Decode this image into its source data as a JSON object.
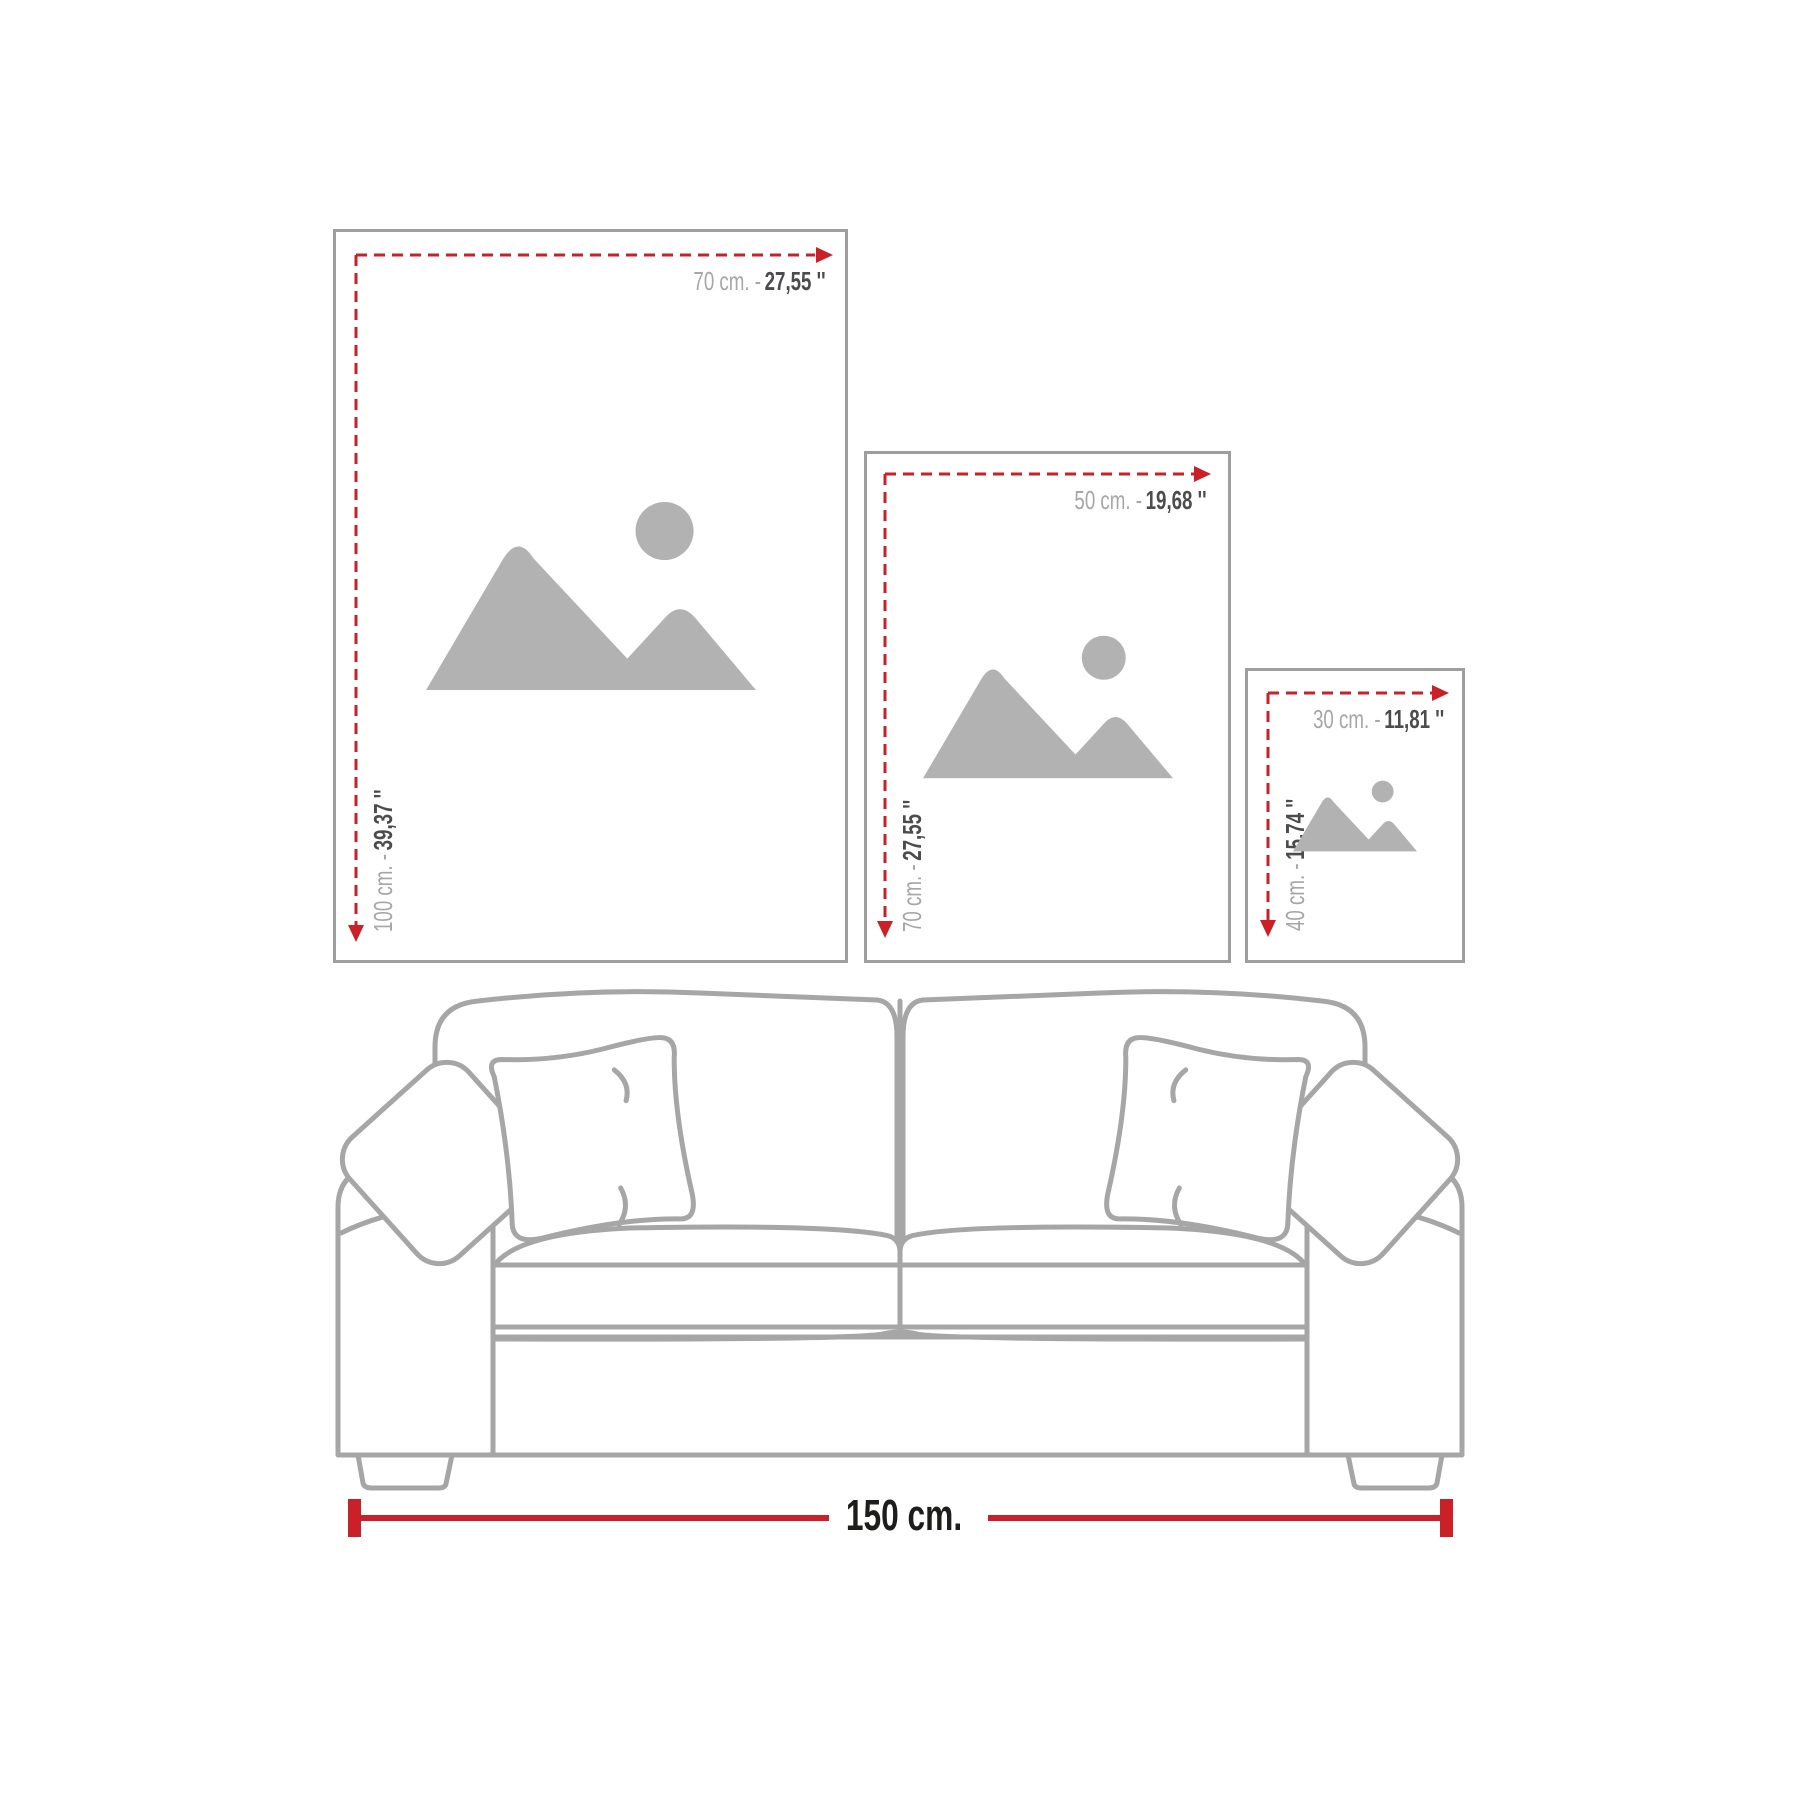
{
  "canvas": {
    "width": 1800,
    "height": 1800,
    "background": "#ffffff"
  },
  "colors": {
    "accent_red": "#c92127",
    "text_light": "#a6a6a8",
    "text_dark": "#4c4c4e",
    "text_black": "#1d1d1b",
    "frame_border": "#9e9e9e",
    "placeholder_gray": "#b2b2b2",
    "sofa_line": "#a6a6a6"
  },
  "frames": [
    {
      "name": "large",
      "width_cm": "70 cm. -",
      "width_in": "27,55 ''",
      "height_cm": "100 cm. -",
      "height_in": "39,37 ''"
    },
    {
      "name": "medium",
      "width_cm": "50 cm. -",
      "width_in": "19,68 ''",
      "height_cm": "70 cm. -",
      "height_in": "27,55 ''"
    },
    {
      "name": "small",
      "width_cm": "30 cm. -",
      "width_in": "11,81 ''",
      "height_cm": "40 cm. -",
      "height_in": "15,74 ''"
    }
  ],
  "sofa": {
    "width_label": "150 cm."
  },
  "icons": {
    "placeholder": "mountains-and-sun-image-placeholder",
    "dimension_arrow": "red-dashed-dimension-arrow"
  }
}
